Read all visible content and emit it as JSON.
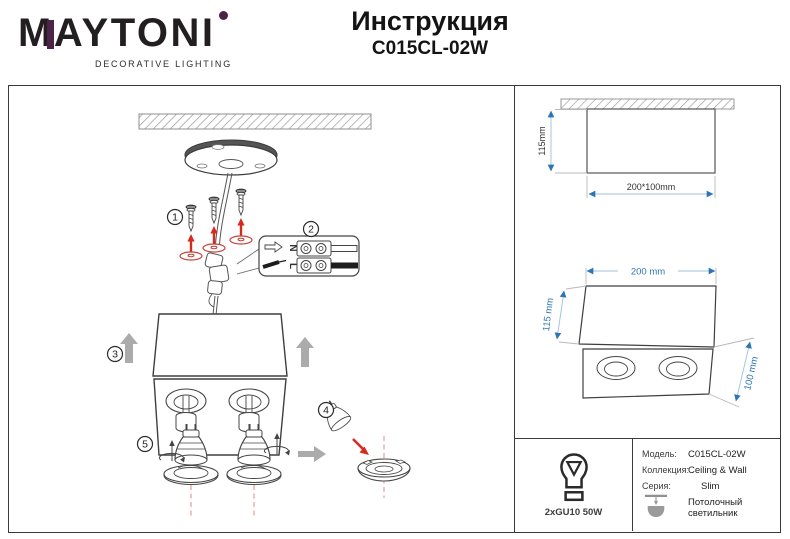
{
  "header": {
    "brand": "MAYTONI",
    "brand_tagline": "DECORATIVE LIGHTING",
    "doc_title": "Инструкция",
    "model": "C015CL-02W"
  },
  "steps": {
    "s1": "1",
    "s2": "2",
    "s3": "3",
    "s4": "4",
    "s5": "5"
  },
  "wiring": {
    "neutral": "N",
    "line": "L"
  },
  "dimensions": {
    "side_height": "115mm",
    "side_footprint": "200*100mm",
    "iso_width": "200 mm",
    "iso_height": "115 mm",
    "iso_depth": "100 mm"
  },
  "specs": {
    "lamp": "2xGU10 50W",
    "model_label": "Модель:",
    "model_value": "C015CL-02W",
    "collection_label": "Коллекция:",
    "collection_value": "Ceiling & Wall",
    "series_label": "Серия:",
    "series_value": "Slim",
    "type": "Потолочный светильник"
  },
  "colors": {
    "accent_purple": "#4c2448",
    "dimension_blue": "#2e75b6",
    "action_red": "#d52b1e",
    "muted_gray": "#ababab"
  }
}
